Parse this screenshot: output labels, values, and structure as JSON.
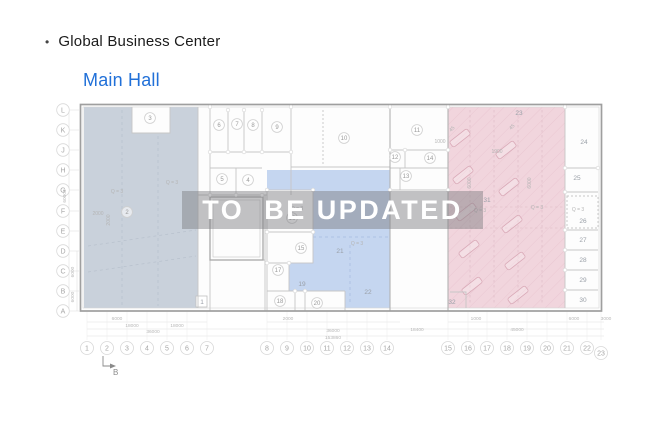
{
  "header": {
    "bullet": "•",
    "title": "Global Business Center"
  },
  "subtitle": "Main Hall",
  "watermark": "TO  BE UPDATED",
  "colors": {
    "accent": "#2170d8",
    "band": "rgba(125,125,129,0.47)",
    "watermark_text": "#ffffff",
    "region_left": "#c9d1db",
    "region_mid": "#c5d6f0",
    "region_right": "#f1d5dd",
    "wall_dark": "#9f9f9f",
    "wall": "#c6c6c6",
    "grid_text": "#a6a6a6",
    "dim_text": "#b8b8b8"
  },
  "plan": {
    "row_axis": [
      {
        "l": "L",
        "y": 110
      },
      {
        "l": "K",
        "y": 130
      },
      {
        "l": "J",
        "y": 150
      },
      {
        "l": "H",
        "y": 170
      },
      {
        "l": "G",
        "y": 190
      },
      {
        "l": "F",
        "y": 211
      },
      {
        "l": "E",
        "y": 231
      },
      {
        "l": "D",
        "y": 251
      },
      {
        "l": "C",
        "y": 271
      },
      {
        "l": "B",
        "y": 291
      },
      {
        "l": "A",
        "y": 311
      }
    ],
    "col_axis": [
      {
        "n": "1",
        "x": 87
      },
      {
        "n": "2",
        "x": 107
      },
      {
        "n": "3",
        "x": 127
      },
      {
        "n": "4",
        "x": 147
      },
      {
        "n": "5",
        "x": 167
      },
      {
        "n": "6",
        "x": 187
      },
      {
        "n": "7",
        "x": 207
      },
      {
        "n": "8",
        "x": 267
      },
      {
        "n": "9",
        "x": 287
      },
      {
        "n": "10",
        "x": 307
      },
      {
        "n": "11",
        "x": 327
      },
      {
        "n": "12",
        "x": 347
      },
      {
        "n": "13",
        "x": 367
      },
      {
        "n": "14",
        "x": 387
      },
      {
        "n": "15",
        "x": 448
      },
      {
        "n": "16",
        "x": 468
      },
      {
        "n": "17",
        "x": 487
      },
      {
        "n": "18",
        "x": 507
      },
      {
        "n": "19",
        "x": 527
      },
      {
        "n": "20",
        "x": 547
      },
      {
        "n": "21",
        "x": 567
      },
      {
        "n": "22",
        "x": 587
      },
      {
        "n": "23",
        "x": 601,
        "dy": 5
      }
    ],
    "rooms_circled": [
      {
        "n": "3",
        "x": 150,
        "y": 118
      },
      {
        "n": "2",
        "x": 127,
        "y": 212
      },
      {
        "n": "6",
        "x": 219,
        "y": 125
      },
      {
        "n": "7",
        "x": 237,
        "y": 124
      },
      {
        "n": "8",
        "x": 253,
        "y": 125
      },
      {
        "n": "9",
        "x": 277,
        "y": 127
      },
      {
        "n": "5",
        "x": 222,
        "y": 179
      },
      {
        "n": "4",
        "x": 248,
        "y": 180
      },
      {
        "n": "10",
        "x": 344,
        "y": 138
      },
      {
        "n": "11",
        "x": 417,
        "y": 130
      },
      {
        "n": "12",
        "x": 395,
        "y": 157
      },
      {
        "n": "14",
        "x": 430,
        "y": 158
      },
      {
        "n": "13",
        "x": 406,
        "y": 176
      },
      {
        "n": "16",
        "x": 292,
        "y": 218
      },
      {
        "n": "15",
        "x": 301,
        "y": 248
      },
      {
        "n": "17",
        "x": 278,
        "y": 270
      },
      {
        "n": "18",
        "x": 280,
        "y": 301
      },
      {
        "n": "20",
        "x": 317,
        "y": 303
      }
    ],
    "rooms_plain": [
      {
        "n": "1",
        "x": 202,
        "y": 304
      },
      {
        "n": "19",
        "x": 302,
        "y": 286
      },
      {
        "n": "21",
        "x": 340,
        "y": 253
      },
      {
        "n": "22",
        "x": 368,
        "y": 294
      },
      {
        "n": "23",
        "x": 519,
        "y": 115
      },
      {
        "n": "31",
        "x": 487,
        "y": 202
      },
      {
        "n": "32",
        "x": 452,
        "y": 304
      },
      {
        "n": "24",
        "x": 584,
        "y": 144
      },
      {
        "n": "25",
        "x": 577,
        "y": 180
      },
      {
        "n": "26",
        "x": 583,
        "y": 223
      },
      {
        "n": "27",
        "x": 583,
        "y": 242
      },
      {
        "n": "28",
        "x": 583,
        "y": 262
      },
      {
        "n": "29",
        "x": 583,
        "y": 282
      },
      {
        "n": "30",
        "x": 583,
        "y": 302
      }
    ],
    "annotations": [
      {
        "t": "Q = 3",
        "x": 117,
        "y": 193
      },
      {
        "t": "Q = 3",
        "x": 172,
        "y": 184
      },
      {
        "t": "Q = 3",
        "x": 297,
        "y": 210
      },
      {
        "t": "Q = 3",
        "x": 357,
        "y": 245
      },
      {
        "t": "Q = 3",
        "x": 480,
        "y": 212
      },
      {
        "t": "Q = 3",
        "x": 537,
        "y": 209
      },
      {
        "t": "Q = 3",
        "x": 578,
        "y": 211
      },
      {
        "t": "2000",
        "x": 98,
        "y": 215
      },
      {
        "t": "2000",
        "x": 110,
        "y": 220,
        "rot": -90
      },
      {
        "t": "1000",
        "x": 440,
        "y": 143
      },
      {
        "t": "1900",
        "x": 497,
        "y": 153
      },
      {
        "t": "6000",
        "x": 471,
        "y": 183,
        "rot": -90
      },
      {
        "t": "6000",
        "x": 531,
        "y": 183,
        "rot": -90
      },
      {
        "t": "45",
        "x": 453,
        "y": 130,
        "rot": -45
      },
      {
        "t": "45",
        "x": 513,
        "y": 128,
        "rot": -45
      }
    ],
    "dims_bottom": [
      {
        "t": "6000",
        "x": 117,
        "y": 320
      },
      {
        "t": "2000",
        "x": 288,
        "y": 320
      },
      {
        "t": "1000",
        "x": 476,
        "y": 320
      },
      {
        "t": "6000",
        "x": 574,
        "y": 320
      },
      {
        "t": "3000",
        "x": 606,
        "y": 320
      },
      {
        "t": "18000",
        "x": 132,
        "y": 327
      },
      {
        "t": "18000",
        "x": 177,
        "y": 327
      },
      {
        "t": "36000",
        "x": 153,
        "y": 333
      },
      {
        "t": "36000",
        "x": 333,
        "y": 332
      },
      {
        "t": "18400",
        "x": 417,
        "y": 331
      },
      {
        "t": "45000",
        "x": 517,
        "y": 331
      },
      {
        "t": "153860",
        "x": 333,
        "y": 339
      }
    ],
    "dims_left": [
      {
        "t": "60000",
        "x": 66,
        "y": 196,
        "rot": -90
      },
      {
        "t": "6000",
        "x": 74,
        "y": 272,
        "rot": -90
      },
      {
        "t": "6000",
        "x": 74,
        "y": 297,
        "rot": -90
      }
    ],
    "section_marker": "B"
  }
}
